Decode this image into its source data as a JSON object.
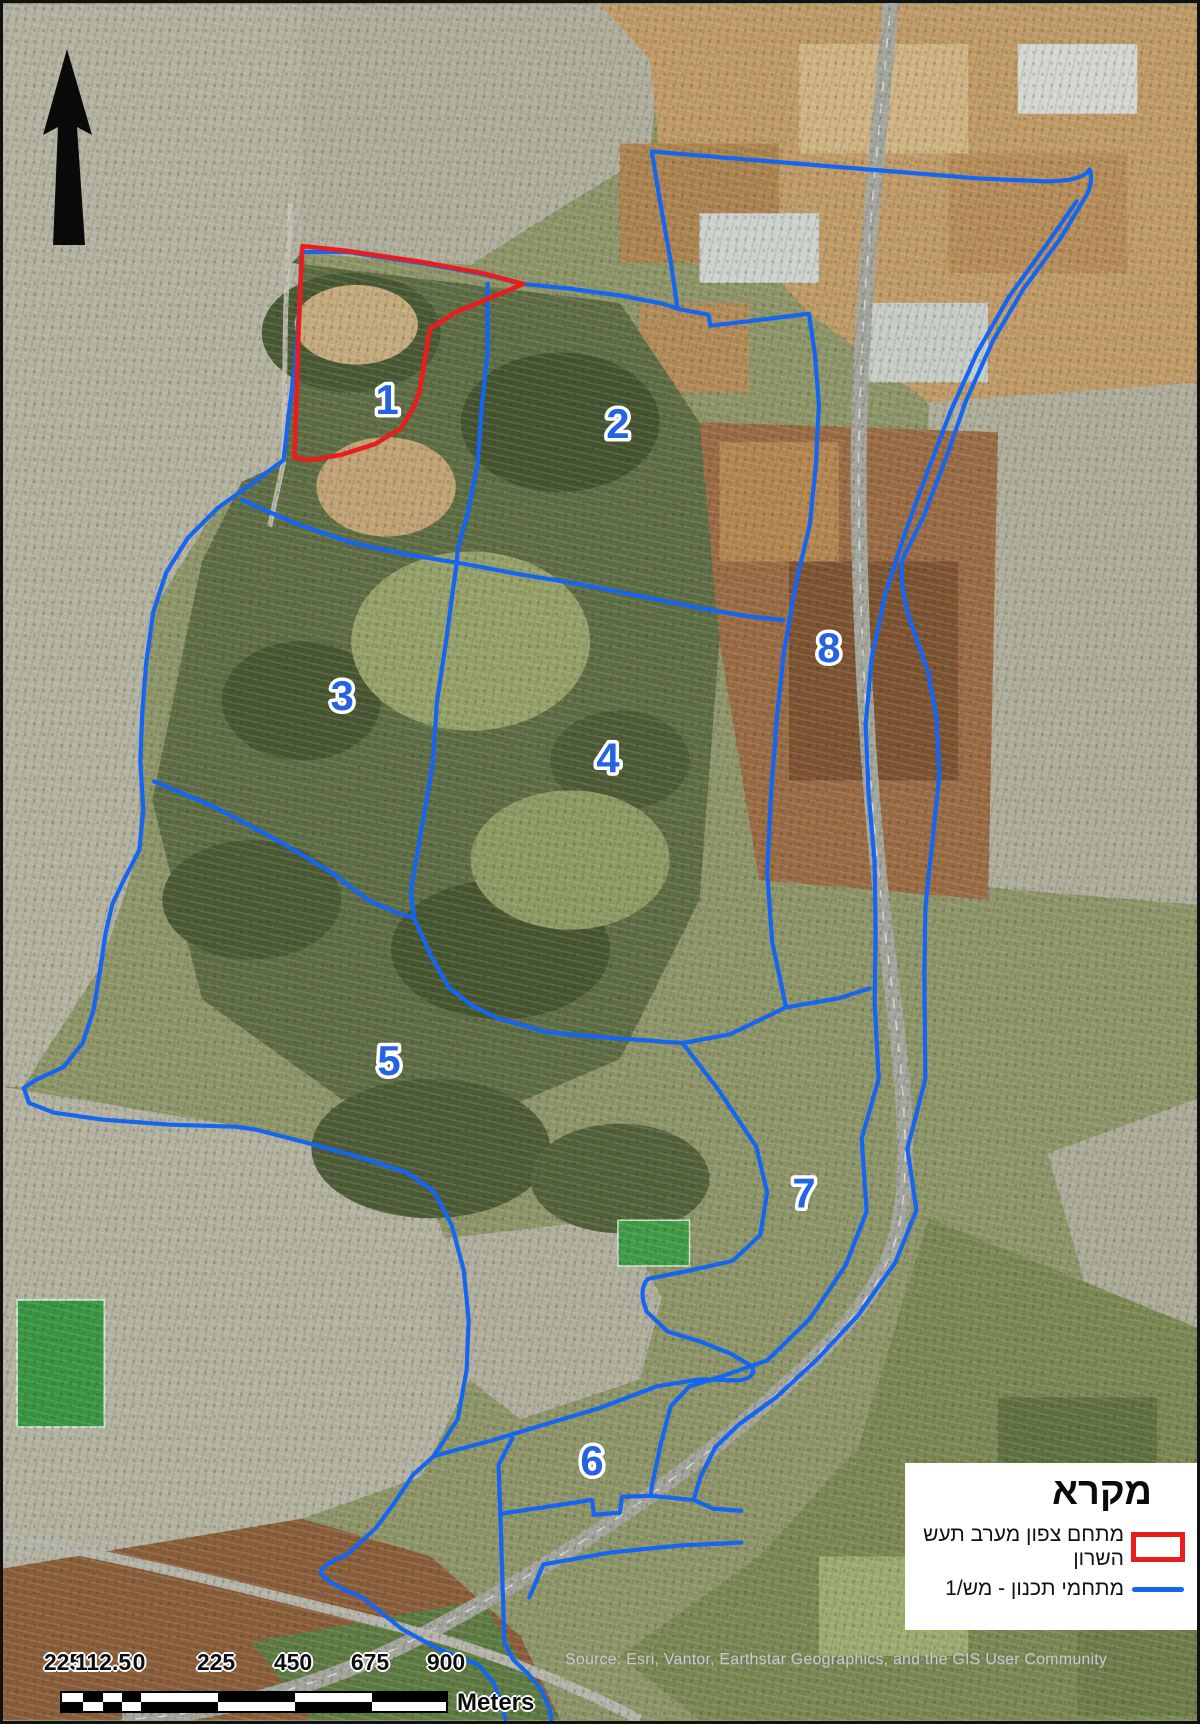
{
  "map": {
    "type": "satellite-plan-map",
    "zones": [
      "1",
      "2",
      "3",
      "4",
      "5",
      "6",
      "7",
      "8"
    ],
    "colors": {
      "plan_outline": "#1565f0",
      "highlight_outline": "#e81e1e",
      "zone_label_fill": "#2563e0"
    }
  },
  "legend": {
    "title": "מקרא",
    "item1_line1": "מתחם צפון מערב תעש",
    "item1_line2": "השרון",
    "item1_symbol": "red-rectangle-outline",
    "item2_label": "מתחמי תכנון - מש/1",
    "item2_symbol": "blue-line"
  },
  "scale_bar": {
    "labels": [
      "225",
      "112.5",
      "0",
      "225",
      "450",
      "675",
      "900"
    ],
    "unit": "Meters"
  },
  "attribution": "Source: Esri, Vantor, Earthstar Geographics, and the GIS User Community",
  "north_arrow": "north-arrow"
}
